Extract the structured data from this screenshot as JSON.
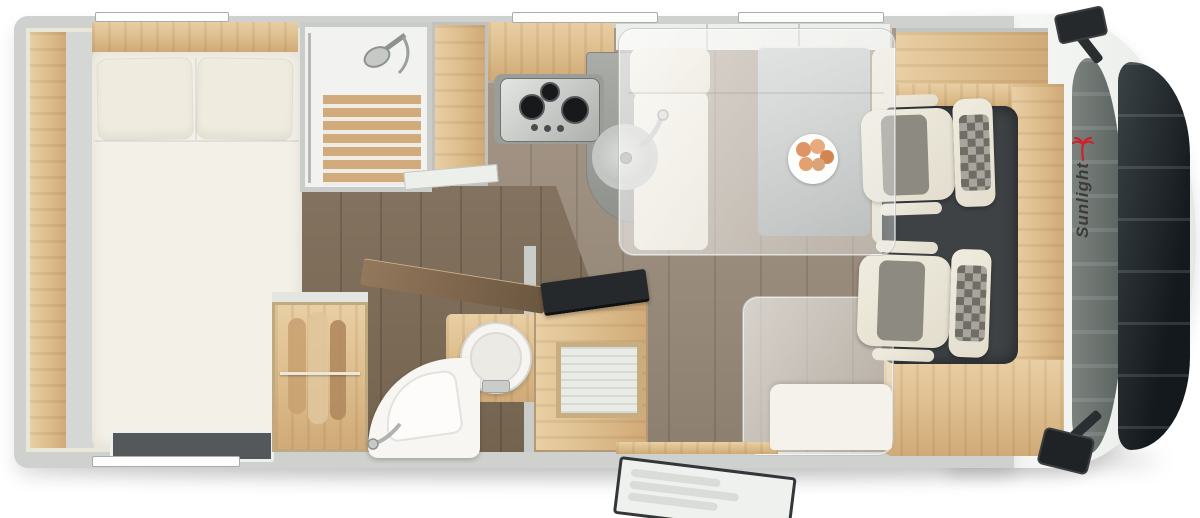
{
  "scene": {
    "type": "motorhome-floor-plan-top-view",
    "brand": "Sunlight",
    "orientation": "rear-left-to-cab-right",
    "background": "#ffffff"
  },
  "logo": {
    "text": "Sunlight",
    "icon": "palm-tree-icon",
    "text_color": "#3b3b3b",
    "icon_color": "#d0202a"
  },
  "palette": {
    "wall": "#ced1cd",
    "wood": "#dcbc8b",
    "wood_dark": "#6b563f",
    "floor_light": "#968878",
    "floor_dark": "#7a6a56",
    "mattress": "#f3f0e8",
    "upholstery": "#ece8db",
    "counter": "#9aa09e",
    "cab_recess": "#3e4245",
    "windshield": "#1a2024",
    "accent_red": "#d0202a"
  },
  "rooms": {
    "bedroom": {
      "name": "rear-bedroom",
      "items": [
        "double-bed",
        "two-pillows",
        "wood-shelf-left",
        "wood-shelf-top",
        "foot-window"
      ]
    },
    "shower": {
      "name": "shower-cabin",
      "items": [
        "shower-head",
        "teak-grating",
        "glass-door"
      ]
    },
    "wardrobe": {
      "name": "tall-wardrobe",
      "items": [
        "open-door"
      ]
    },
    "kitchen": {
      "name": "kitchenette",
      "items": [
        "3-burner-gas-hob",
        "round-sink",
        "faucet",
        "worktop",
        "overhead-locker"
      ]
    },
    "bathroom": {
      "name": "washroom",
      "items": [
        "corner-washbasin",
        "toilet",
        "clothes-wardrobe",
        "open-door"
      ]
    },
    "dinette": {
      "name": "half-dinette",
      "items": [
        "table",
        "bench-seat",
        "side-seat",
        "plate-with-rolls",
        "drop-down-bed-overlay",
        "overhead-lockers"
      ]
    },
    "entrance": {
      "name": "entry",
      "items": [
        "open-entry-door",
        "threshold",
        "tv-panel",
        "tambour-cabinet"
      ]
    },
    "cab": {
      "name": "driver-cab",
      "items": [
        "driver-seat",
        "passenger-seat",
        "checkered-head-cushions",
        "wood-surround",
        "windshield",
        "front-grille",
        "side-mirror-top",
        "side-mirror-bottom"
      ]
    }
  },
  "counts": {
    "hob_burners": 3,
    "cab_seats": 2,
    "top_wall_windows": 3,
    "bottom_wall_windows": 1,
    "bread_rolls": 5
  }
}
